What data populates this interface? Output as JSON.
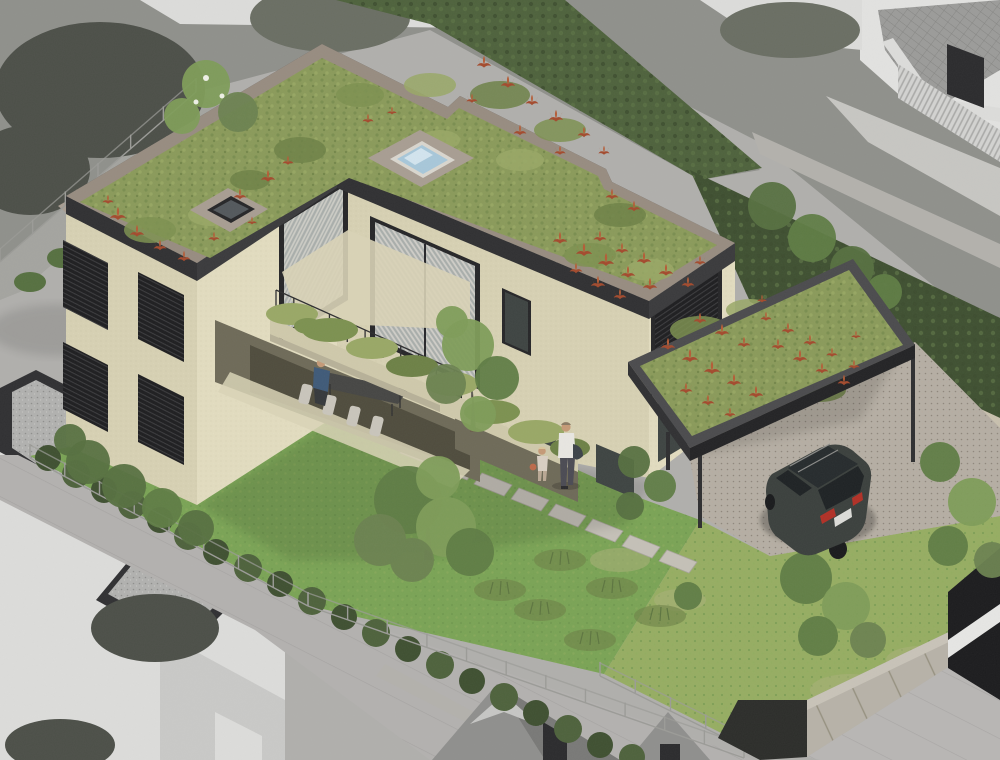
{
  "scene": {
    "type": "architectural-rendering",
    "view": "isometric aerial view",
    "style": "subject property shown in color, neighbouring context desaturated grayscale",
    "subject": "modern flat-roof residence with extensive green roof, recessed corner balcony, ground terrace, carport with green roof and garden",
    "elements": [
      "main-building",
      "green-roof-with-red-plants",
      "blue-glass-skylight",
      "dark-skylight",
      "corner-balcony-with-planters",
      "ground-terrace-with-dining-table",
      "carport-green-roof",
      "dark-suv",
      "garden-lawn",
      "garden-trees",
      "stone-boundary-wall",
      "tall-hedge",
      "mesh-fences",
      "concrete-panel-wall",
      "gray-neighbor-flat-roof-building",
      "gray-neighbor-pitched-roof-houses",
      "gray-street",
      "man-with-child-on-path",
      "person-seated-on-terrace"
    ],
    "people_count": 3,
    "vehicles_count": 1
  },
  "colors": {
    "bg": "#b0afac",
    "grayLawn": "#8f908b",
    "grayLawnLight": "#a4a49f",
    "grayBush": "#4c4f48",
    "grayTree": "#6a6e63",
    "whiteWall": "#dcdcda",
    "houseWall": "#e2e2e0",
    "roofGray": "#9b9b99",
    "balustrade": "#d3d3d1",
    "terraceGray": "#c7c6c2",
    "retWall": "#b3b1ac",
    "street": "#b3b1af",
    "flatRoofGravel": "#b1b1af",
    "parapetDark": "#303032",
    "parapetTop": "#4b4b4d",
    "gableRoof": "#8f8f8d",
    "gableRoofDark": "#797977",
    "dormer": "#c6c6c4",
    "darkWin": "#2b2b2d",
    "concWall": "#b7b2a8",
    "concWallLight": "#c8c3b8",
    "darkWallSeg": "#2c2d2a",
    "pavingBR": "#b8b6b4",
    "darkGlassBld": "#1c1c1e",
    "whiteBand": "#e6e6e4",
    "lawn": "#7aa355",
    "lawnLight": "#96ad62",
    "lawnDry": "#aab079",
    "hedge": "#4e623c",
    "hedgeDark": "#3f5031",
    "treeGreen": "#5f7c45",
    "treeLight": "#7e9c58",
    "treeOlive": "#6b8250",
    "shrub": "#567040",
    "stoneWall": "#aca18f",
    "stoneCoping": "#c8c0ae",
    "stoneJoint": "#8d8372",
    "facade": "#d7d1b3",
    "facadeLight": "#e2dcbf",
    "facadeShade": "#b9b299",
    "recessDark": "#6e6a58",
    "recessDarker": "#4f4c3d",
    "frameDark": "#262628",
    "louver": "#1e1e20",
    "slatLine": "#3c3c3e",
    "glass": "#a9aeab",
    "glassDark": "#3e4442",
    "curtain": "#d9d6cf",
    "roofGreenBase": "#8a9a5a",
    "roofGreen1": "#7c9150",
    "roofGreen2": "#99a866",
    "roofGreen3": "#6d8146",
    "gravel": "#978c80",
    "gravelLight": "#a89d92",
    "red1": "#a34a2d",
    "red2": "#b55c36",
    "skyFrame": "#d9d6ce",
    "skyGlass": "#a7c7d9",
    "skyGlassLight": "#d2e4ee",
    "slabConc": "#cfc9ab",
    "railDark": "#2e2e30",
    "driveGravel": "#b5aea3",
    "pathPaver": "#c4c0b7",
    "carBody": "#3b403d",
    "carDark": "#242826",
    "carGlass": "#262b2d",
    "tailRed": "#b13026",
    "wheelDark": "#191a1c",
    "skin": "#c59a77",
    "shirtWhite": "#e8e6e1",
    "personBlue": "#3f5a78",
    "trouser": "#4b4b53",
    "childTop": "#d9cfc2",
    "tableDark": "#464644",
    "chairLight": "#c9c5bb",
    "trunk": "#6b5f4e",
    "fence": "#9b9b97",
    "jacket": "#3c4248"
  },
  "stamps": {
    "tufts_main": [
      [
        118,
        216,
        1
      ],
      [
        137,
        233,
        0.9
      ],
      [
        160,
        247,
        0.8
      ],
      [
        184,
        258,
        0.8
      ],
      [
        108,
        201,
        0.7
      ],
      [
        240,
        196,
        0.8
      ],
      [
        268,
        178,
        0.9
      ],
      [
        288,
        162,
        0.7
      ],
      [
        214,
        238,
        0.7
      ],
      [
        252,
        222,
        0.6
      ],
      [
        368,
        120,
        0.7
      ],
      [
        392,
        112,
        0.6
      ],
      [
        484,
        64,
        0.9
      ],
      [
        508,
        84,
        0.9
      ],
      [
        532,
        102,
        0.8
      ],
      [
        556,
        118,
        0.9
      ],
      [
        584,
        134,
        0.8
      ],
      [
        472,
        100,
        0.7
      ],
      [
        520,
        132,
        0.8
      ],
      [
        560,
        152,
        0.7
      ],
      [
        604,
        152,
        0.7
      ],
      [
        612,
        196,
        0.8
      ],
      [
        634,
        208,
        0.8
      ],
      [
        560,
        240,
        0.9
      ],
      [
        584,
        252,
        1
      ],
      [
        606,
        262,
        1
      ],
      [
        628,
        274,
        0.9
      ],
      [
        650,
        286,
        0.9
      ],
      [
        600,
        238,
        0.8
      ],
      [
        622,
        250,
        0.8
      ],
      [
        644,
        260,
        0.9
      ],
      [
        666,
        272,
        0.9
      ],
      [
        688,
        284,
        0.8
      ],
      [
        576,
        270,
        0.8
      ],
      [
        598,
        284,
        0.9
      ],
      [
        620,
        296,
        0.8
      ],
      [
        700,
        262,
        0.7
      ]
    ],
    "tufts_carport": [
      [
        668,
        346,
        0.9
      ],
      [
        690,
        358,
        1
      ],
      [
        712,
        370,
        1
      ],
      [
        734,
        382,
        0.9
      ],
      [
        756,
        394,
        0.9
      ],
      [
        778,
        346,
        0.8
      ],
      [
        800,
        358,
        0.9
      ],
      [
        822,
        370,
        0.8
      ],
      [
        844,
        382,
        0.8
      ],
      [
        700,
        320,
        0.8
      ],
      [
        722,
        332,
        0.9
      ],
      [
        744,
        344,
        0.8
      ],
      [
        766,
        318,
        0.7
      ],
      [
        788,
        330,
        0.8
      ],
      [
        810,
        342,
        0.8
      ],
      [
        832,
        354,
        0.7
      ],
      [
        854,
        366,
        0.7
      ],
      [
        686,
        390,
        0.8
      ],
      [
        708,
        402,
        0.8
      ],
      [
        730,
        414,
        0.7
      ],
      [
        762,
        300,
        0.6
      ],
      [
        856,
        336,
        0.6
      ]
    ],
    "roof_blobs": [
      [
        150,
        230,
        26,
        13,
        1
      ],
      [
        210,
        215,
        22,
        11,
        2
      ],
      [
        300,
        150,
        26,
        13,
        3
      ],
      [
        360,
        95,
        24,
        12,
        1
      ],
      [
        430,
        85,
        26,
        12,
        2
      ],
      [
        500,
        95,
        30,
        14,
        3
      ],
      [
        560,
        130,
        26,
        12,
        1
      ],
      [
        520,
        160,
        24,
        11,
        2
      ],
      [
        620,
        215,
        26,
        12,
        3
      ],
      [
        590,
        255,
        26,
        12,
        1
      ],
      [
        650,
        270,
        24,
        11,
        2
      ],
      [
        440,
        140,
        20,
        10,
        2
      ],
      [
        250,
        180,
        20,
        10,
        3
      ],
      [
        700,
        330,
        30,
        14,
        1
      ],
      [
        760,
        360,
        28,
        13,
        2
      ],
      [
        820,
        390,
        26,
        12,
        3
      ],
      [
        750,
        310,
        24,
        11,
        2
      ],
      [
        840,
        350,
        22,
        11,
        1
      ],
      [
        700,
        390,
        22,
        10,
        3
      ]
    ],
    "tree_blobs": [
      [
        408,
        500,
        34,
        0
      ],
      [
        446,
        527,
        30,
        1
      ],
      [
        380,
        540,
        26,
        2
      ],
      [
        438,
        478,
        22,
        1
      ],
      [
        470,
        552,
        24,
        0
      ],
      [
        412,
        560,
        22,
        2
      ],
      [
        468,
        345,
        26,
        1
      ],
      [
        497,
        378,
        22,
        0
      ],
      [
        446,
        384,
        20,
        2
      ],
      [
        478,
        414,
        18,
        1
      ],
      [
        452,
        322,
        16,
        1
      ],
      [
        88,
        462,
        22,
        3
      ],
      [
        124,
        486,
        22,
        3
      ],
      [
        162,
        508,
        20,
        0
      ],
      [
        196,
        528,
        18,
        3
      ],
      [
        70,
        440,
        16,
        3
      ],
      [
        806,
        578,
        26,
        0
      ],
      [
        846,
        606,
        24,
        1
      ],
      [
        818,
        636,
        20,
        0
      ],
      [
        868,
        640,
        18,
        2
      ],
      [
        772,
        206,
        24,
        3
      ],
      [
        812,
        238,
        24,
        0
      ],
      [
        852,
        268,
        22,
        3
      ],
      [
        884,
        292,
        18,
        0
      ],
      [
        206,
        84,
        24,
        1
      ],
      [
        238,
        112,
        20,
        2
      ],
      [
        182,
        116,
        18,
        1
      ],
      [
        634,
        462,
        16,
        3
      ],
      [
        660,
        486,
        16,
        0
      ],
      [
        630,
        506,
        14,
        3
      ],
      [
        688,
        596,
        14,
        0
      ],
      [
        940,
        462,
        20,
        0
      ],
      [
        972,
        502,
        24,
        1
      ],
      [
        948,
        546,
        20,
        0
      ],
      [
        992,
        560,
        18,
        2
      ]
    ],
    "hedge_blobs": [
      [
        48,
        458,
        13
      ],
      [
        76,
        474,
        14
      ],
      [
        104,
        490,
        13
      ],
      [
        132,
        505,
        14
      ],
      [
        160,
        520,
        13
      ],
      [
        188,
        536,
        14
      ],
      [
        216,
        552,
        13
      ],
      [
        248,
        568,
        14
      ],
      [
        280,
        584,
        13
      ],
      [
        312,
        601,
        14
      ],
      [
        344,
        617,
        13
      ],
      [
        376,
        633,
        14
      ],
      [
        408,
        649,
        13
      ],
      [
        440,
        665,
        14
      ],
      [
        472,
        681,
        13
      ],
      [
        504,
        697,
        14
      ],
      [
        536,
        713,
        13
      ],
      [
        568,
        729,
        14
      ],
      [
        600,
        745,
        13
      ],
      [
        632,
        757,
        13
      ]
    ],
    "pavers": [
      [
        408,
        442
      ],
      [
        445,
        457
      ],
      [
        482,
        473
      ],
      [
        519,
        488
      ],
      [
        556,
        504
      ],
      [
        593,
        519
      ],
      [
        630,
        535
      ],
      [
        667,
        550
      ]
    ],
    "grass_tufts": [
      [
        560,
        560
      ],
      [
        612,
        588
      ],
      [
        540,
        610
      ],
      [
        660,
        616
      ],
      [
        590,
        640
      ],
      [
        500,
        590
      ]
    ],
    "dry_patches": [
      [
        850,
        690,
        40,
        16
      ],
      [
        920,
        660,
        34,
        14
      ],
      [
        800,
        722,
        30,
        12
      ],
      [
        958,
        700,
        30,
        13
      ],
      [
        880,
        732,
        36,
        13
      ],
      [
        620,
        560,
        30,
        12
      ],
      [
        680,
        600,
        26,
        11
      ]
    ],
    "fences": [
      {
        "x1": 0,
        "y1": 262,
        "x2": 196,
        "y2": 92,
        "posts": 6
      },
      {
        "x1": 30,
        "y1": 458,
        "x2": 308,
        "y2": 606,
        "posts": 8
      },
      {
        "x1": 308,
        "y1": 606,
        "x2": 744,
        "y2": 758,
        "posts": 11
      },
      {
        "x1": 600,
        "y1": 676,
        "x2": 741,
        "y2": 746,
        "posts": 4
      }
    ],
    "carport_posts": [
      [
        700,
        448,
        700,
        528
      ],
      [
        913,
        344,
        913,
        462
      ],
      [
        668,
        432,
        668,
        470
      ]
    ],
    "rail": {
      "x1": 276,
      "y1": 310,
      "x2": 472,
      "y2": 398,
      "n": 11,
      "h": 20
    },
    "stone_joints": {
      "x1": 756,
      "y1": 316,
      "x2": 996,
      "y2": 428,
      "n": 22,
      "len": 14
    }
  },
  "building": {
    "roof_outline": "66,196 322,44 448,107 460,96 606,169 612,182 735,243 649,301 337,170 197,263",
    "roof_green_inset": "80,202 322,58 447,119 459,108 598,176 604,189 717,245 648,288 349,178 210,258",
    "carport_roof": "628,362 853,259 915,345 690,448",
    "carport_green": "640,366 849,270 903,345 692,436"
  }
}
